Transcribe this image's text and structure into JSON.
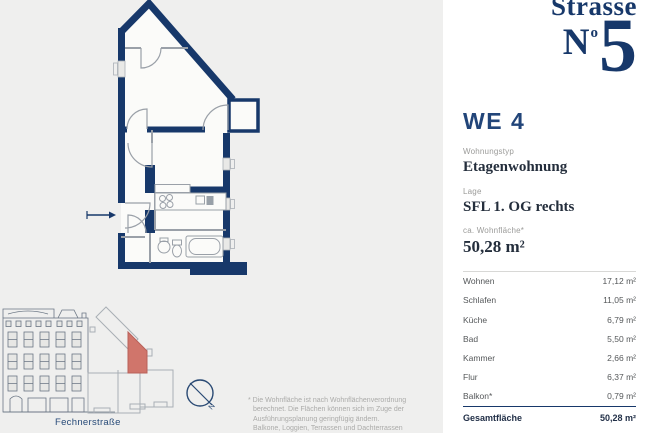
{
  "colors": {
    "navy": "#17386a",
    "accent_red": "#d0756b",
    "panel_bg": "#ffffff",
    "page_bg": "#efefee"
  },
  "logo": {
    "line1": "Strasse",
    "n": "N",
    "o": "o",
    "five": "5"
  },
  "unit": {
    "title": "WE 4",
    "fields": [
      {
        "label": "Wohnungstyp",
        "value": "Etagenwohnung"
      },
      {
        "label": "Lage",
        "value": "SFL 1. OG rechts"
      },
      {
        "label": "ca. Wohnfläche*",
        "value": "50,28 m²"
      }
    ],
    "rooms": [
      {
        "name": "Wohnen",
        "area": "17,12 m²"
      },
      {
        "name": "Schlafen",
        "area": "11,05 m²"
      },
      {
        "name": "Küche",
        "area": "6,79 m²"
      },
      {
        "name": "Bad",
        "area": "5,50 m²"
      },
      {
        "name": "Kammer",
        "area": "2,66 m²"
      },
      {
        "name": "Flur",
        "area": "6,37 m²"
      },
      {
        "name": "Balkon*",
        "area": "0,79 m²"
      }
    ],
    "total": {
      "name": "Gesamtfläche",
      "area": "50,28 m²"
    }
  },
  "map": {
    "street": "Fechnerstraße",
    "north": "N"
  },
  "footnote": {
    "lines": [
      "* Die Wohnfläche ist nach Wohnflächenverordnung",
      "berechnet. Die Flächen können sich im Zuge der",
      "Ausführungsplanung geringfügig ändern.",
      "Balkone, Loggien, Terrassen und Dachterrassen",
      "werden zu 50 % angerechnet. Angaben ohne"
    ]
  }
}
